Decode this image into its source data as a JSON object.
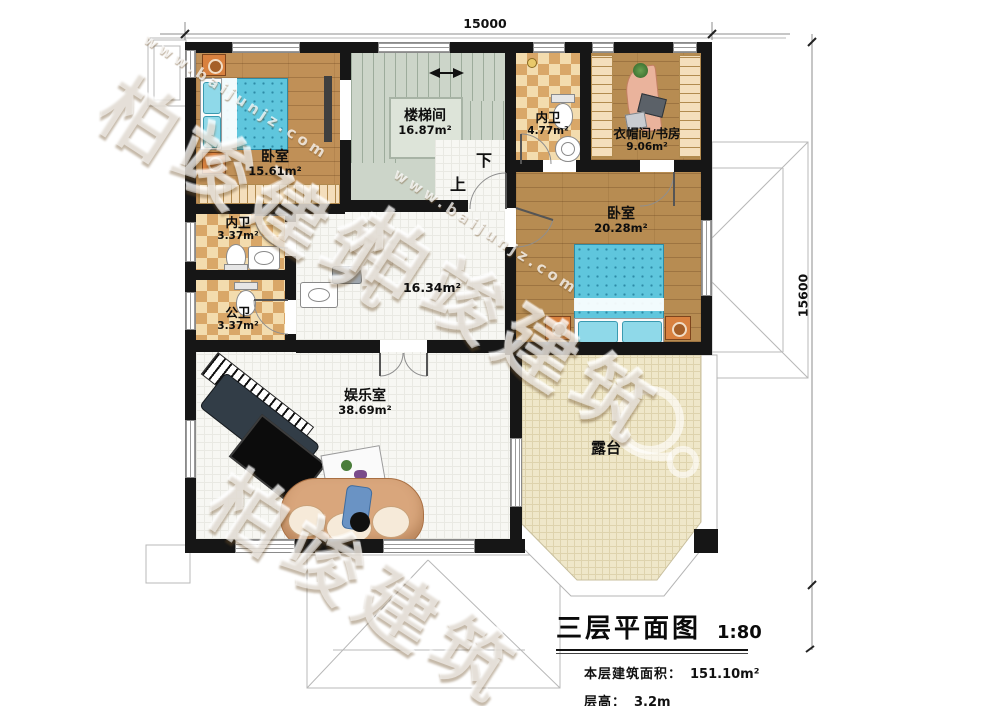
{
  "watermark": {
    "brand": "柏竣建筑",
    "url": "www.baijunjz.com"
  },
  "dimensions": {
    "top_width_mm": "15000",
    "right_height_mm": "15600"
  },
  "rooms": {
    "bedroom_top_left": {
      "name": "卧室",
      "area": "15.61m²"
    },
    "stairwell": {
      "name": "楼梯间",
      "area": "16.87m²"
    },
    "bathroom_top": {
      "name": "内卫",
      "area": "4.77m²"
    },
    "cloakroom_study": {
      "name": "衣帽间/书房",
      "area": "9.06m²"
    },
    "bedroom_right": {
      "name": "卧室",
      "area": "20.28m²"
    },
    "bathroom_mid": {
      "name": "内卫",
      "area": "3.37m²"
    },
    "bathroom_public": {
      "name": "公卫",
      "area": "3.37m²"
    },
    "hallway": {
      "area": "16.34m²"
    },
    "entertainment": {
      "name": "娱乐室",
      "area": "38.69m²"
    },
    "terrace": {
      "name": "露台"
    }
  },
  "stairs": {
    "down": "下",
    "up": "上"
  },
  "title_block": {
    "title": "三层平面图",
    "scale": "1:80",
    "area_label": "本层建筑面积：",
    "area_value": "151.10m²",
    "floor_height_label": "层高：",
    "floor_height_value": "3.2m"
  },
  "palette": {
    "wall": "#161616",
    "wood_floor": "#b78c52",
    "tile_light": "#f3dcae",
    "tile_dark": "#d9a768",
    "stair_floor": "#ccd5c9",
    "bed": "#5fc6dd",
    "terrace_floor": "#efe7c9",
    "white_tile": "#f7f7f3"
  }
}
